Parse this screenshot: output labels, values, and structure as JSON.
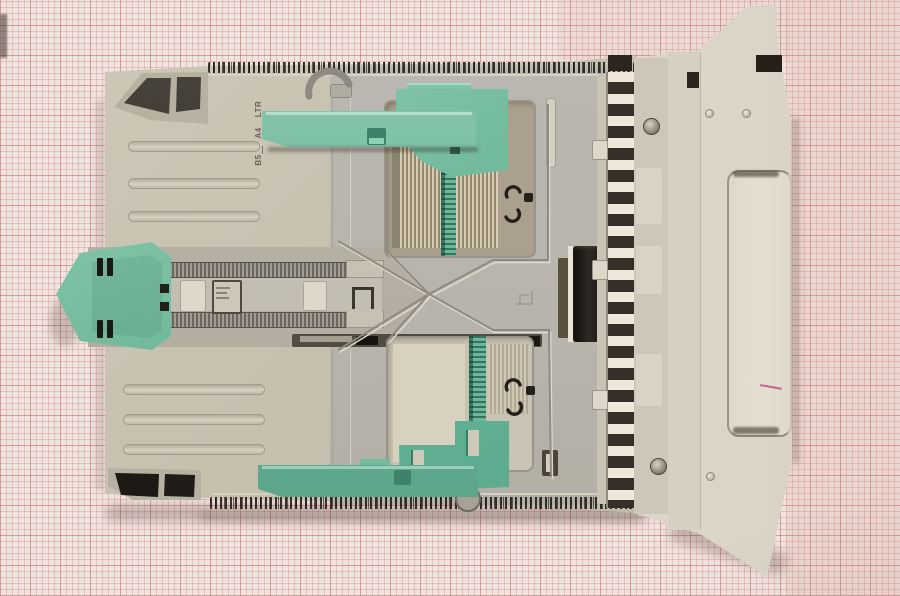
{
  "scene": {
    "description": "Top-down photograph of a beige printer paper-tray cassette with green adjustable paper guides lying on pink millimeter graph paper",
    "background": "graph-paper"
  },
  "markings": {
    "paper_sizes": [
      {
        "label": "LTR"
      },
      {
        "label": "A4"
      },
      {
        "label": "B5"
      }
    ]
  },
  "colors": {
    "paper": "#f0e4e0",
    "grid_minor": "#cc8076",
    "grid_major": "#ba5c52",
    "tray_beige": "#c6c0af",
    "tray_floor": "#b9b6ae",
    "front_panel": "#ded8ca",
    "guide_green": "#6ab596",
    "guide_green_dark": "#4e9c81",
    "rubber_black": "#1c1814"
  }
}
